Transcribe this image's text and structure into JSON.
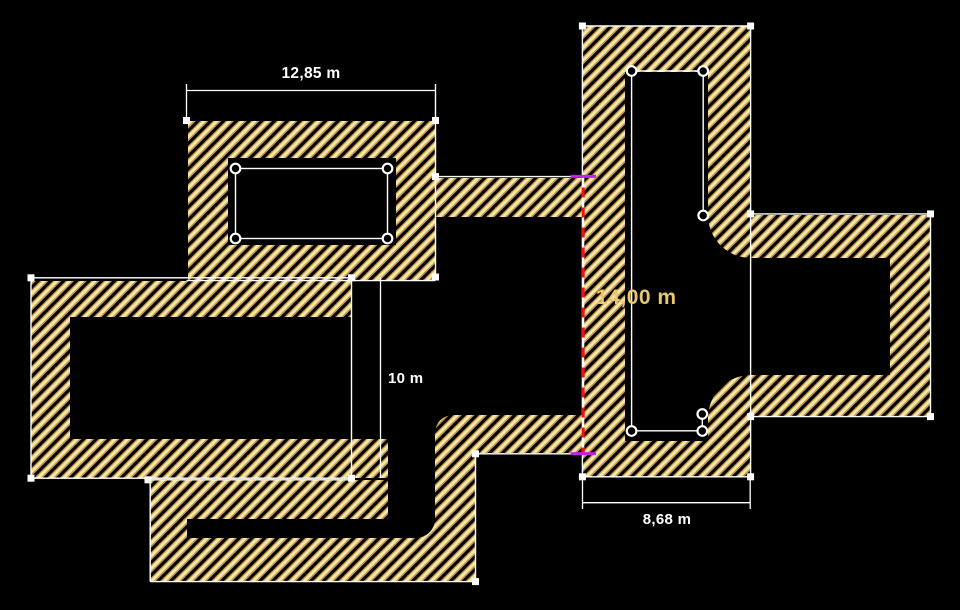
{
  "colors": {
    "background": "#000000",
    "hatch_stripe": "#f5e5ab",
    "hatch_edge": "#cfa145",
    "selection_outline": "#ffffff",
    "measure_line_red": "#ee1111",
    "measure_tick_magenta": "#c320e8",
    "measure_label_gold": "#e9c76f",
    "dimension_label_white": "#ffffff"
  },
  "dimensions": {
    "top_width": "12,85 m",
    "middle_height": "10 m",
    "bottom_width": "8,68 m"
  },
  "measurement": {
    "value": "14,00 m"
  }
}
